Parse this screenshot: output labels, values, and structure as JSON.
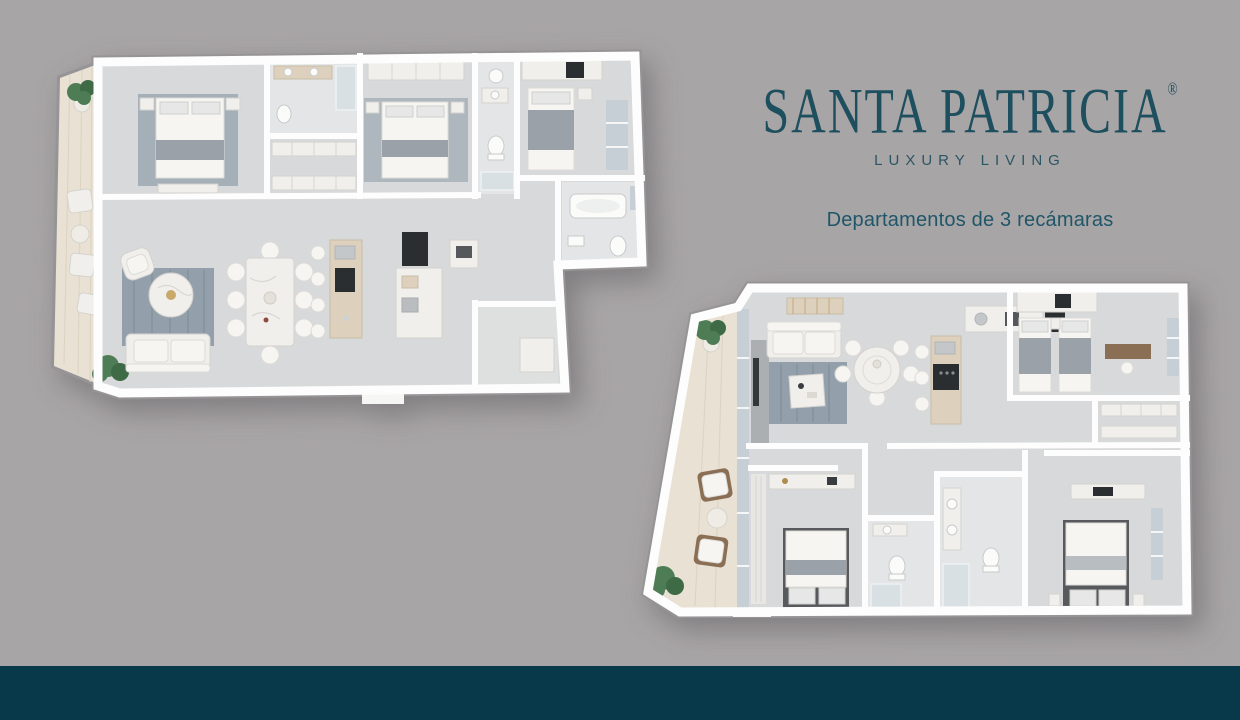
{
  "brand": {
    "name": "SANTA PATRICIA",
    "registered_mark": "®",
    "tagline": "LUXURY LIVING",
    "color": "#1e4f5e"
  },
  "subtitle": {
    "text": "Departamentos de 3 recámaras"
  },
  "floorplans": {
    "count": 2,
    "left_id": "floorplan-left",
    "right_id": "floorplan-right"
  },
  "colors": {
    "background": "#a8a5a6",
    "footer_bar": "#07394a",
    "brand_teal": "#1e4f5e",
    "floor_gray": "#d7d9da",
    "rug_blue_gray": "#93a0ac",
    "balcony_wood": "#e9e1d3",
    "plant_green": "#4e7d55",
    "wall_white": "#fdfdfd"
  }
}
